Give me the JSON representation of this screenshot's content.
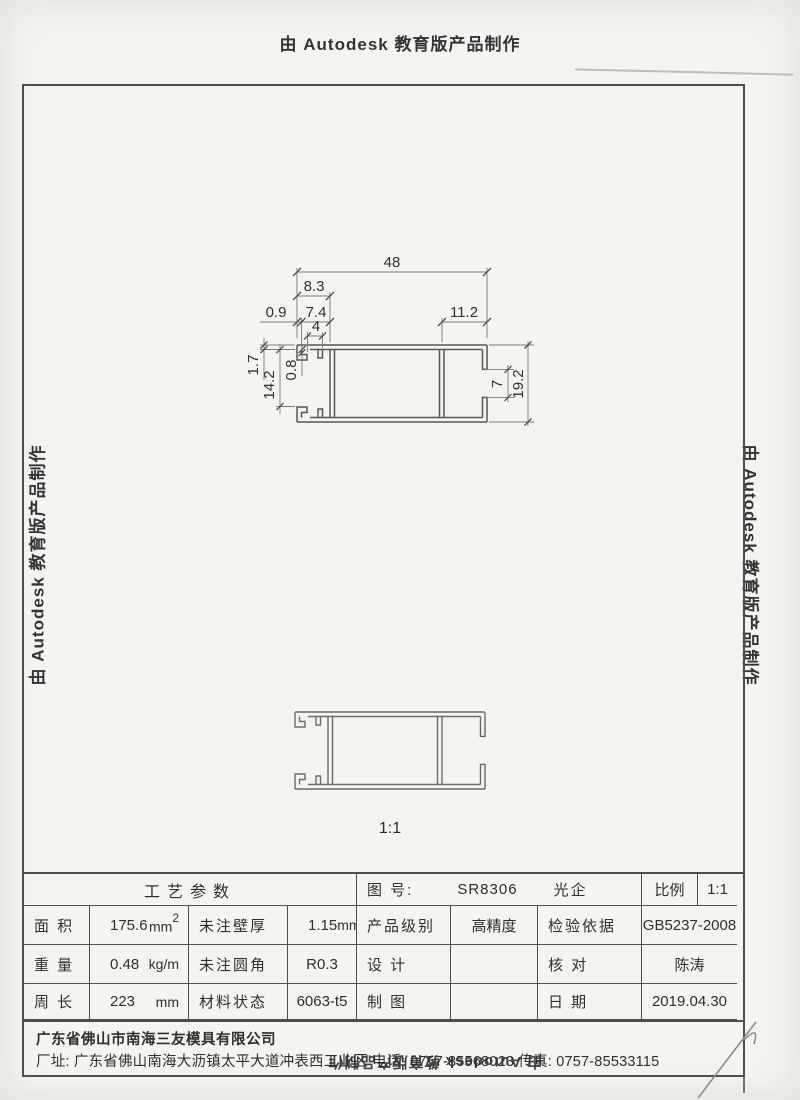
{
  "watermarks": {
    "top": "由 Autodesk 教育版产品制作",
    "left": "由 Autodesk 教育版产品制作",
    "right": "由 Autodesk 教育版产品制作",
    "bottom": "由 Autodesk 教育版产品制作"
  },
  "drawing": {
    "scale_note": "1:1",
    "dimensions": {
      "overall_width": "48",
      "hook_section_width": "8.3",
      "lip_width": "0.9",
      "hook_inner_width": "7.4",
      "stub_gap": "4",
      "channel_depth": "11.2",
      "flange_thickness": "1.7",
      "left_height": "14.2",
      "web_thickness": "0.8",
      "channel_opening": "7",
      "overall_height": "19.2"
    }
  },
  "title_block": {
    "process_header": "工艺参数",
    "drawing_no_label": "图 号:",
    "drawing_no": "SR8306",
    "product_name": "光企",
    "scale_label": "比例",
    "scale_value": "1:1",
    "area_label": "面 积",
    "area_value": "175.6",
    "area_unit": "mm",
    "area_unit_sup": "2",
    "wall_label": "未注壁厚",
    "wall_value": "1.15",
    "wall_unit": "mm",
    "grade_label": "产品级别",
    "grade_value": "高精度",
    "basis_label": "检验依据",
    "basis_value": "GB5237-2008",
    "weight_label": "重 量",
    "weight_value": "0.48",
    "weight_unit": "kg/m",
    "fillet_label": "未注圆角",
    "fillet_value": "R0.3",
    "design_label": "设 计",
    "design_value": "",
    "check_label": "核 对",
    "check_value": "陈涛",
    "perimeter_label": "周 长",
    "perimeter_value": "223",
    "perimeter_unit": "mm",
    "material_label": "材料状态",
    "material_value": "6063-t5",
    "draft_label": "制 图",
    "draft_value": "",
    "date_label": "日 期",
    "date_value": "2019.04.30"
  },
  "footer": {
    "company": "广东省佛山市南海三友模具有限公司",
    "address": "厂址: 广东省佛山南海大沥镇太平大道冲表西工业区 电话: 0757-85568023 传真: 0757-85533115"
  }
}
